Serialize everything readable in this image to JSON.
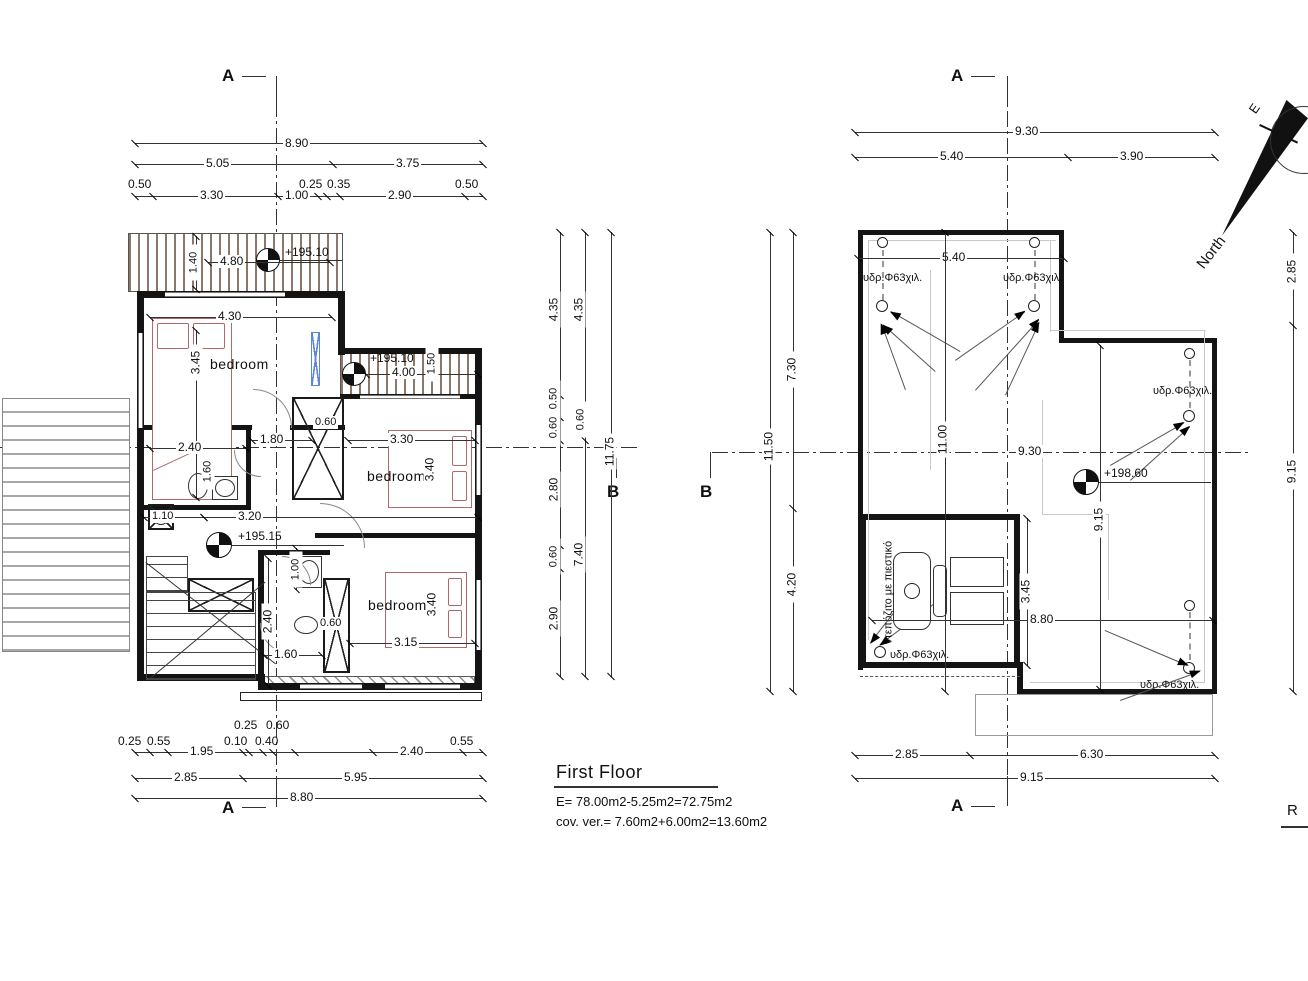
{
  "title_block": {
    "title": "First Floor",
    "area": "E= 78.00m2-5.25m2=72.75m2",
    "coverage": "cov. ver.= 7.60m2+6.00m2=13.60m2",
    "roof_title_partial": "R"
  },
  "markers": {
    "section_a": "A",
    "section_b": "B",
    "north": "North",
    "east": "E"
  },
  "floor_plan": {
    "rooms": {
      "bedroom": "bedroom"
    },
    "levels": {
      "balcony_top": "+195.10",
      "balcony_right": "+195.10",
      "hall": "+195.15"
    },
    "dims_top": [
      "8.90",
      "5.05",
      "3.75",
      "0.50",
      "3.30",
      "1.00",
      "0.25",
      "0.35",
      "2.90",
      "0.50"
    ],
    "dims_bottom": [
      "0.25",
      "0.55",
      "1.95",
      "0.10",
      "0.40",
      "0.25",
      "0.60",
      "2.40",
      "0.55",
      "2.85",
      "5.95",
      "8.80"
    ],
    "dims_right_col": [
      "4.35",
      "0.50",
      "0.60",
      "2.80",
      "0.60",
      "2.90",
      "4.35",
      "0.60",
      "7.40",
      "11.75"
    ],
    "dims_interior": {
      "balcony_w": "4.80",
      "balcony_d": "1.40",
      "bed1_w": "4.30",
      "bed1_h": "3.45",
      "bath1_w": "2.40",
      "bath1_h": "1.60",
      "hall_w": "1.80",
      "closet_d": "0.60",
      "bed2_w": "3.30",
      "bed2_h": "3.40",
      "balc2_w": "4.00",
      "balc2_d": "1.50",
      "chimney_w": "1.10",
      "hall2_w": "3.20",
      "door_w": "1.00",
      "bath2_h": "2.40",
      "bath2_w": "1.60",
      "closet2_d": "0.60",
      "bed3_w": "3.15",
      "bed3_h": "3.40"
    }
  },
  "roof_plan": {
    "levels": {
      "roof": "+198.60"
    },
    "downpipe_label": "υδρ.Φ63χιλ.",
    "tank_label": "ντεπόζιτο με πιεστικό",
    "dims_top": [
      "9.30",
      "5.40",
      "3.90"
    ],
    "dims_left": [
      "11.50",
      "7.30",
      "4.20"
    ],
    "dims_right": [
      "2.85",
      "9.15"
    ],
    "dims_bottom": [
      "2.85",
      "6.30",
      "9.15"
    ],
    "dims_interior": {
      "top_w": "5.40",
      "left_h": "11.00",
      "mid_w": "9.30",
      "mid_h": "9.15",
      "tank_h": "3.45",
      "low_w": "8.80"
    }
  }
}
